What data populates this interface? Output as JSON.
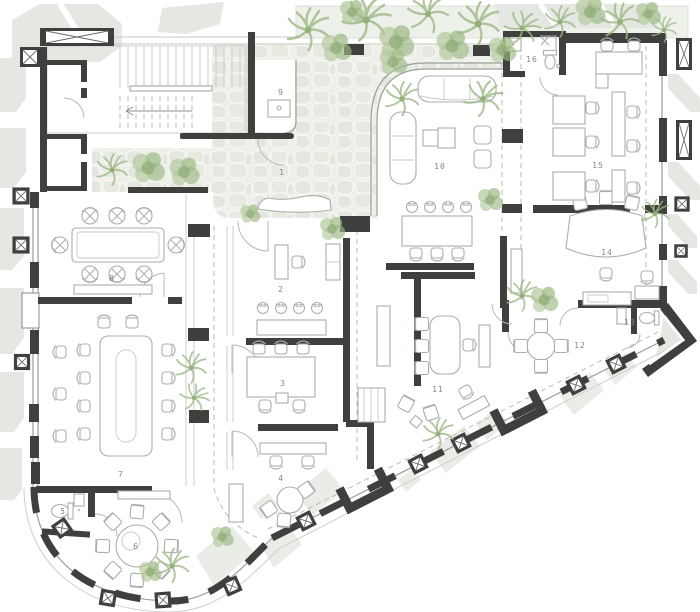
{
  "drawing": {
    "kind_label": "floor plan",
    "rooms": [
      {
        "number": "1"
      },
      {
        "number": "2"
      },
      {
        "number": "3"
      },
      {
        "number": "4"
      },
      {
        "number": "5"
      },
      {
        "number": "6"
      },
      {
        "number": "7"
      },
      {
        "number": "8"
      },
      {
        "number": "9"
      },
      {
        "number": "10"
      },
      {
        "number": "11"
      },
      {
        "number": "12"
      },
      {
        "number": "13"
      },
      {
        "number": "14"
      },
      {
        "number": "15"
      },
      {
        "number": "16"
      }
    ],
    "colors": {
      "wall": "#3f403e",
      "furniture_line": "#a9afaa",
      "plant_green": "#9db884",
      "stone_background": "#edefe8",
      "stone": "#e4e7df",
      "outside_shadow": "#e5e7e3",
      "label_text": "#82887f"
    }
  }
}
